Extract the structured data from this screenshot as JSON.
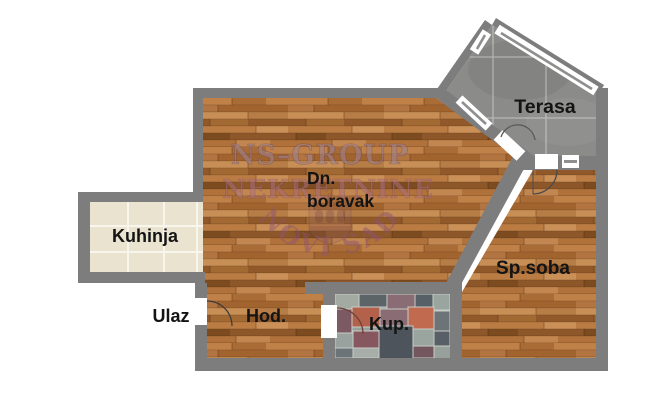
{
  "title": "Apartment floor plan",
  "rooms": [
    {
      "id": "kuhinja",
      "label": "Kuhinja",
      "floor": "beige ceramic tile"
    },
    {
      "id": "dnevni-boravak",
      "label_line1": "Dn.",
      "label_line2": "boravak",
      "floor": "wood parquet"
    },
    {
      "id": "terasa",
      "label": "Terasa",
      "floor": "gray concrete tile"
    },
    {
      "id": "spavaca-soba",
      "label": "Sp.soba",
      "floor": "wood parquet"
    },
    {
      "id": "hodnik",
      "label": "Hod.",
      "floor": "wood parquet"
    },
    {
      "id": "kupatilo",
      "label": "Kup.",
      "floor": "mosaic tile"
    },
    {
      "id": "ulaz",
      "label": "Ulaz",
      "floor": "entrance (outside wall)"
    }
  ],
  "watermark": {
    "line1": "NS–GROUP",
    "line2": "NEKRETNINE",
    "arc_text": "NOVI SAD"
  },
  "colors": {
    "background": "#ffffff",
    "wall_gray": "#7d7d7d",
    "wood_base": "#b5743d",
    "kitchen_tile": "#eae3d0",
    "terrace_floor": "#8b8b89",
    "bathroom_base": "#98a09b",
    "opening_white": "#ffffff",
    "label_text": "#141414",
    "watermark_line1": "#9b8497",
    "watermark_line2": "#a96f83",
    "watermark_arc": "#8d5470"
  }
}
